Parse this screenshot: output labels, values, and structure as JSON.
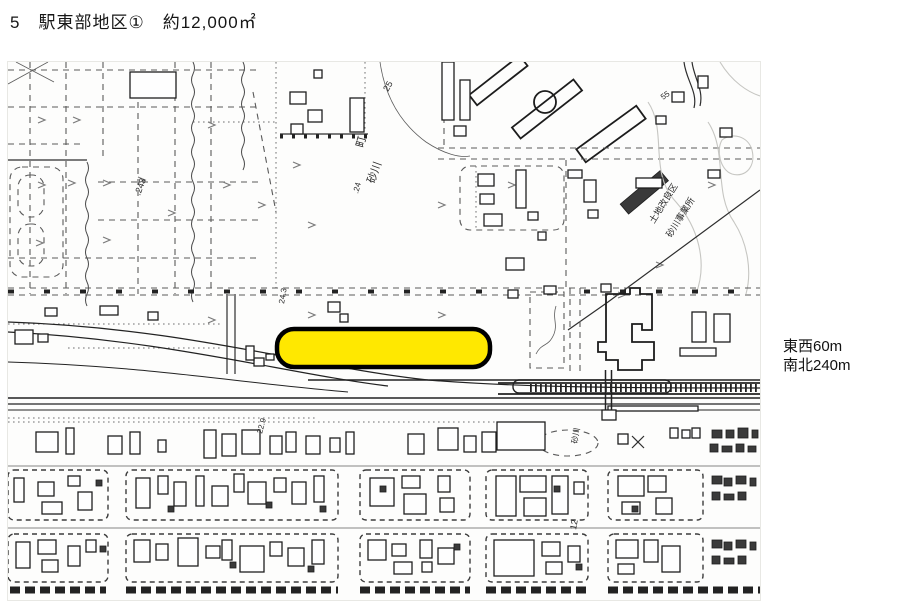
{
  "page": {
    "title": "5　駅東部地区①　約12,000㎡"
  },
  "side_label": {
    "line1": "東西60m",
    "line2": "南北240m"
  },
  "map": {
    "highlight": {
      "x": 269,
      "y": 267,
      "width": 213,
      "height": 38,
      "rx": 17,
      "fill": "#ffe800",
      "outline": "#000000",
      "outline_width": 4.5
    },
    "labels": [
      {
        "text": "町",
        "x": 355,
        "y": 86,
        "r": -75,
        "s": 11
      },
      {
        "text": "砂川",
        "x": 366,
        "y": 122,
        "r": -70,
        "s": 11
      },
      {
        "text": ".24",
        "x": 350,
        "y": 132,
        "r": -75,
        "s": 8
      },
      {
        "text": ".243",
        "x": 132,
        "y": 134,
        "r": -70,
        "s": 9
      },
      {
        "text": "24.3",
        "x": 276,
        "y": 242,
        "r": -80,
        "s": 8
      },
      {
        "text": "25",
        "x": 380,
        "y": 30,
        "r": -60,
        "s": 9
      },
      {
        "text": "55",
        "x": 655,
        "y": 38,
        "r": -35,
        "s": 8
      },
      {
        "text": "22.9",
        "x": 254,
        "y": 372,
        "r": -75,
        "s": 8
      },
      {
        "text": "土地改良区",
        "x": 646,
        "y": 162,
        "r": -58,
        "s": 9
      },
      {
        "text": "砂川事業所",
        "x": 663,
        "y": 176,
        "r": -58,
        "s": 9
      },
      {
        "text": "砂川",
        "x": 569,
        "y": 382,
        "r": -80,
        "s": 8
      },
      {
        "text": "12",
        "x": 568,
        "y": 468,
        "r": -80,
        "s": 9
      }
    ],
    "buildings": [
      [
        122,
        10,
        46,
        26
      ],
      [
        282,
        30,
        16,
        12
      ],
      [
        300,
        48,
        14,
        12
      ],
      [
        283,
        62,
        12,
        10
      ],
      [
        306,
        8,
        8,
        8
      ],
      [
        342,
        36,
        14,
        34
      ],
      [
        434,
        0,
        12,
        58
      ],
      [
        452,
        18,
        10,
        40
      ],
      [
        446,
        64,
        12,
        10
      ],
      [
        560,
        108,
        14,
        8
      ],
      [
        576,
        118,
        12,
        22
      ],
      [
        580,
        148,
        10,
        8
      ],
      [
        628,
        116,
        26,
        10
      ],
      [
        700,
        108,
        12,
        8
      ],
      [
        712,
        66,
        12,
        9
      ],
      [
        690,
        14,
        10,
        12
      ],
      [
        664,
        30,
        12,
        10
      ],
      [
        648,
        54,
        10,
        8
      ],
      [
        470,
        112,
        16,
        12
      ],
      [
        472,
        132,
        14,
        10
      ],
      [
        476,
        152,
        18,
        12
      ],
      [
        508,
        108,
        10,
        38
      ],
      [
        498,
        196,
        18,
        12
      ],
      [
        520,
        150,
        10,
        8
      ],
      [
        530,
        170,
        8,
        8
      ],
      [
        7,
        268,
        18,
        14
      ],
      [
        30,
        272,
        10,
        8
      ],
      [
        37,
        246,
        12,
        8
      ],
      [
        92,
        244,
        18,
        9
      ],
      [
        140,
        250,
        10,
        8
      ],
      [
        320,
        240,
        12,
        10
      ],
      [
        332,
        252,
        8,
        8
      ],
      [
        500,
        228,
        10,
        8
      ],
      [
        536,
        224,
        12,
        8
      ],
      [
        593,
        222,
        10,
        8
      ],
      [
        246,
        296,
        10,
        8
      ],
      [
        258,
        292,
        8,
        6
      ],
      [
        238,
        284,
        8,
        14
      ],
      [
        684,
        250,
        14,
        30
      ],
      [
        706,
        252,
        16,
        28
      ],
      [
        672,
        286,
        36,
        8
      ],
      [
        594,
        348,
        14,
        10
      ],
      [
        28,
        370,
        22,
        20
      ],
      [
        58,
        366,
        8,
        26
      ],
      [
        100,
        374,
        14,
        18
      ],
      [
        122,
        370,
        10,
        22
      ],
      [
        150,
        378,
        8,
        12
      ],
      [
        196,
        368,
        12,
        28
      ],
      [
        214,
        372,
        14,
        22
      ],
      [
        234,
        368,
        18,
        24
      ],
      [
        262,
        374,
        12,
        18
      ],
      [
        278,
        370,
        10,
        20
      ],
      [
        298,
        374,
        14,
        18
      ],
      [
        322,
        376,
        10,
        14
      ],
      [
        338,
        370,
        8,
        22
      ],
      [
        400,
        372,
        16,
        20
      ],
      [
        430,
        366,
        20,
        22
      ],
      [
        456,
        374,
        12,
        16
      ],
      [
        474,
        370,
        14,
        20
      ],
      [
        489,
        360,
        48,
        28
      ],
      [
        610,
        372,
        10,
        10
      ],
      [
        662,
        366,
        8,
        10
      ],
      [
        674,
        368,
        8,
        8
      ],
      [
        684,
        366,
        8,
        10
      ],
      [
        6,
        416,
        10,
        24
      ],
      [
        30,
        420,
        16,
        14
      ],
      [
        34,
        440,
        20,
        12
      ],
      [
        60,
        414,
        12,
        10
      ],
      [
        70,
        430,
        14,
        18
      ],
      [
        128,
        416,
        14,
        30
      ],
      [
        150,
        414,
        10,
        18
      ],
      [
        166,
        420,
        12,
        24
      ],
      [
        188,
        414,
        8,
        30
      ],
      [
        204,
        424,
        16,
        20
      ],
      [
        226,
        412,
        10,
        18
      ],
      [
        240,
        420,
        18,
        22
      ],
      [
        266,
        416,
        12,
        14
      ],
      [
        284,
        420,
        14,
        22
      ],
      [
        306,
        414,
        10,
        26
      ],
      [
        362,
        416,
        24,
        28
      ],
      [
        394,
        414,
        18,
        12
      ],
      [
        396,
        432,
        22,
        20
      ],
      [
        430,
        414,
        12,
        16
      ],
      [
        432,
        436,
        14,
        14
      ],
      [
        488,
        414,
        20,
        40
      ],
      [
        512,
        414,
        26,
        16
      ],
      [
        516,
        436,
        22,
        18
      ],
      [
        544,
        414,
        16,
        38
      ],
      [
        566,
        420,
        10,
        12
      ],
      [
        610,
        414,
        26,
        20
      ],
      [
        640,
        414,
        18,
        16
      ],
      [
        614,
        440,
        18,
        12
      ],
      [
        648,
        436,
        16,
        16
      ],
      [
        8,
        480,
        14,
        26
      ],
      [
        30,
        478,
        18,
        14
      ],
      [
        34,
        498,
        16,
        12
      ],
      [
        60,
        484,
        12,
        20
      ],
      [
        78,
        478,
        10,
        12
      ],
      [
        126,
        478,
        16,
        22
      ],
      [
        148,
        482,
        12,
        16
      ],
      [
        170,
        476,
        20,
        28
      ],
      [
        198,
        484,
        14,
        12
      ],
      [
        214,
        478,
        10,
        20
      ],
      [
        232,
        484,
        24,
        26
      ],
      [
        262,
        480,
        12,
        14
      ],
      [
        280,
        486,
        16,
        18
      ],
      [
        304,
        478,
        12,
        24
      ],
      [
        360,
        478,
        18,
        20
      ],
      [
        384,
        482,
        14,
        12
      ],
      [
        386,
        500,
        18,
        12
      ],
      [
        412,
        478,
        12,
        18
      ],
      [
        430,
        486,
        16,
        16
      ],
      [
        414,
        500,
        10,
        10
      ],
      [
        486,
        478,
        40,
        36
      ],
      [
        534,
        480,
        18,
        14
      ],
      [
        538,
        500,
        16,
        12
      ],
      [
        560,
        484,
        12,
        16
      ],
      [
        608,
        478,
        22,
        18
      ],
      [
        636,
        478,
        14,
        22
      ],
      [
        610,
        502,
        16,
        10
      ],
      [
        654,
        484,
        18,
        26
      ]
    ],
    "buildings_dark": [
      [
        88,
        418,
        6,
        6
      ],
      [
        160,
        444,
        6,
        6
      ],
      [
        258,
        440,
        6,
        6
      ],
      [
        312,
        444,
        6,
        6
      ],
      [
        372,
        424,
        6,
        6
      ],
      [
        546,
        424,
        6,
        6
      ],
      [
        92,
        484,
        6,
        6
      ],
      [
        222,
        500,
        6,
        6
      ],
      [
        300,
        504,
        6,
        6
      ],
      [
        446,
        482,
        6,
        6
      ],
      [
        568,
        502,
        6,
        6
      ],
      [
        624,
        444,
        6,
        6
      ],
      [
        704,
        368,
        10,
        8
      ],
      [
        718,
        368,
        8,
        8
      ],
      [
        730,
        366,
        10,
        10
      ],
      [
        744,
        368,
        6,
        8
      ],
      [
        702,
        382,
        8,
        8
      ],
      [
        714,
        384,
        10,
        6
      ],
      [
        728,
        382,
        8,
        8
      ],
      [
        740,
        384,
        8,
        6
      ],
      [
        704,
        414,
        10,
        8
      ],
      [
        716,
        416,
        8,
        8
      ],
      [
        728,
        414,
        10,
        8
      ],
      [
        742,
        416,
        6,
        8
      ],
      [
        704,
        430,
        8,
        8
      ],
      [
        716,
        432,
        10,
        6
      ],
      [
        730,
        430,
        8,
        8
      ],
      [
        704,
        478,
        10,
        8
      ],
      [
        716,
        480,
        8,
        8
      ],
      [
        728,
        478,
        10,
        8
      ],
      [
        742,
        480,
        6,
        8
      ],
      [
        704,
        494,
        8,
        8
      ],
      [
        716,
        496,
        10,
        6
      ],
      [
        730,
        494,
        8,
        8
      ]
    ]
  }
}
